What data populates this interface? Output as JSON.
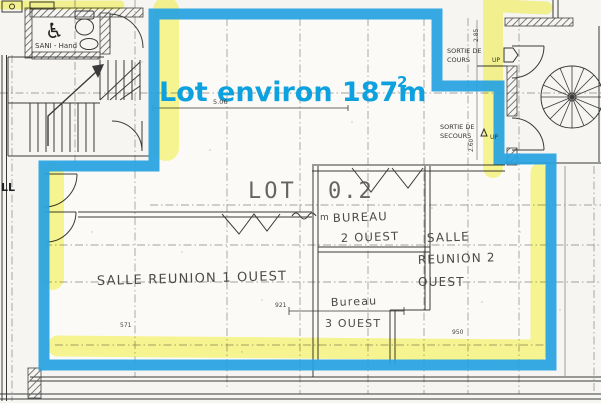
{
  "plan": {
    "annotation": {
      "title": "Lot environ 187m",
      "title_sup": "2",
      "color": "#0ea1df"
    },
    "lot_label": {
      "name": "LOT",
      "number": "0.2"
    },
    "rooms": {
      "salle_reunion_1": {
        "label": "SALLE REUNION 1 OUEST"
      },
      "bureau_2": {
        "unit": "m",
        "line1": "BUREAU",
        "line2": "2 OUEST"
      },
      "bureau_3": {
        "line1": "Bureau",
        "line2": "3 OUEST"
      },
      "salle_reunion_2": {
        "line1": "SALLE",
        "line2": "REUNION 2",
        "line3": "OUEST"
      }
    },
    "exits": {
      "cours": {
        "line1": "SORTIE DE",
        "line2": "COURS",
        "up": "UP"
      },
      "secours": {
        "line1": "SORTIE DE",
        "line2": "SECOURS",
        "up": "UP"
      }
    },
    "sanitary": {
      "label": "SANI - Hand",
      "symbol": "♿"
    },
    "hall_label": "LL",
    "dimensions": {
      "d_506": "5.06",
      "d_285": "2.85",
      "d_260": "2.60",
      "d_571": "571",
      "d_921": "921",
      "d_950": "950"
    },
    "colors": {
      "outline": "#27a2e2",
      "highlight": "#f6f440",
      "ink": "#3a3a3a",
      "paper": "#f6f5f1"
    }
  }
}
